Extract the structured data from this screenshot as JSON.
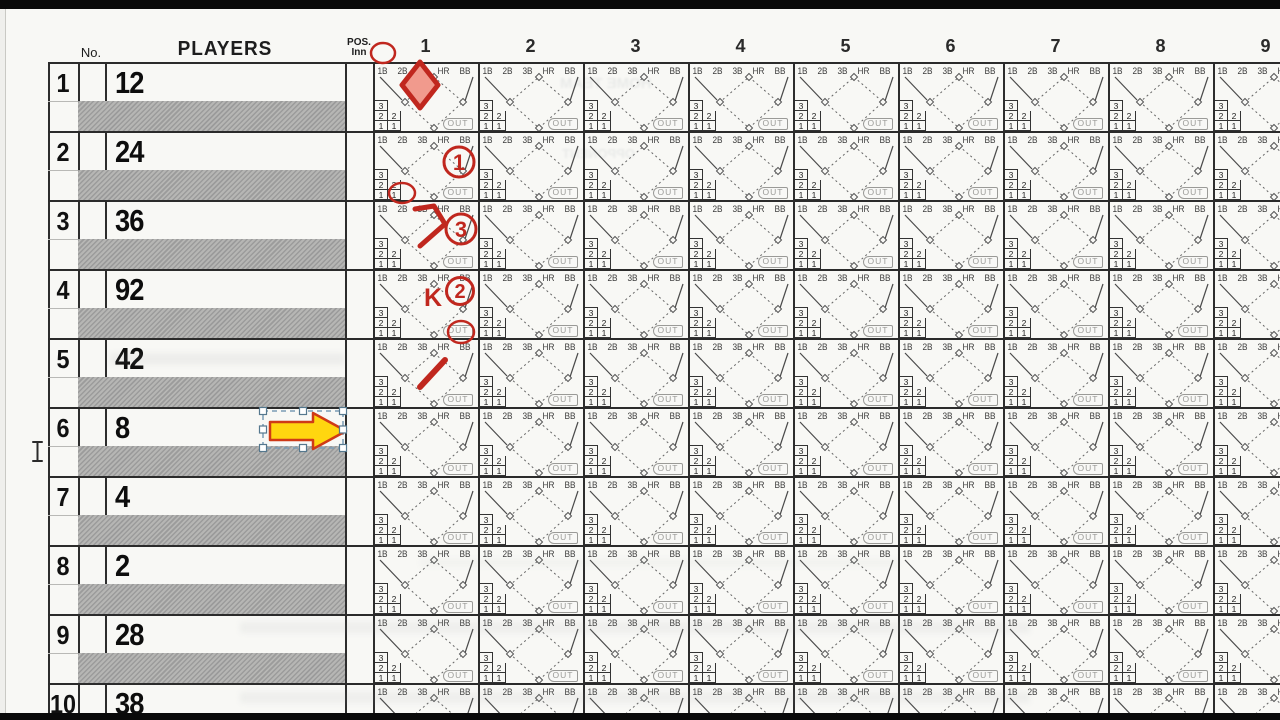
{
  "document": {
    "kind": "baseball scorebook page (scanned)"
  },
  "header": {
    "no": "No.",
    "players": "PLAYERS",
    "pos_line1": "POS.",
    "pos_line2": "Inn",
    "innings": [
      "1",
      "2",
      "3",
      "4",
      "5",
      "6",
      "7",
      "8",
      "9"
    ]
  },
  "cell": {
    "base_labels": [
      "1B",
      "2B",
      "3B",
      "HR",
      "BB"
    ],
    "counter_rows": [
      [
        "3"
      ],
      [
        "2",
        "2"
      ],
      [
        "1",
        "1"
      ]
    ],
    "out_label": "OUT"
  },
  "roster": [
    {
      "order": "1",
      "number": "12"
    },
    {
      "order": "2",
      "number": "24"
    },
    {
      "order": "3",
      "number": "36"
    },
    {
      "order": "4",
      "number": "92"
    },
    {
      "order": "5",
      "number": "42"
    },
    {
      "order": "6",
      "number": "8"
    },
    {
      "order": "7",
      "number": "4"
    },
    {
      "order": "8",
      "number": "2"
    },
    {
      "order": "9",
      "number": "28"
    },
    {
      "order": "10",
      "number": "38"
    }
  ],
  "annotations": {
    "ink_color": "#c0271e",
    "marks": [
      {
        "id": "row1-hit-1b-circle",
        "kind": "circled-base-label",
        "label": "1B"
      },
      {
        "id": "row1-scored-diamond",
        "kind": "filled-diamond",
        "label": ""
      },
      {
        "id": "row2-out-number",
        "kind": "circled-number",
        "label": "1"
      },
      {
        "id": "row3-hit-2b-circle",
        "kind": "circled-base-label",
        "label": "2B"
      },
      {
        "id": "row3-advance-path",
        "kind": "base-path",
        "label": ""
      },
      {
        "id": "row3-out-number",
        "kind": "circled-number",
        "label": "3"
      },
      {
        "id": "row4-strikeout",
        "kind": "letter",
        "label": "K"
      },
      {
        "id": "row4-out-number",
        "kind": "circled-number",
        "label": "2"
      },
      {
        "id": "row5-walk-bb-circle",
        "kind": "circled-base-label",
        "label": "BB"
      },
      {
        "id": "row5-advance-path",
        "kind": "base-path",
        "label": ""
      }
    ],
    "arrow_tool": {
      "selected": true,
      "fill": "#ffd60f",
      "outline": "#cf3a17",
      "handle_color": "#ffffff",
      "selection_color": "#7b9cb5"
    }
  },
  "ghost_texts": [
    "HOME TEAM",
    "OPPONENT"
  ],
  "colors": {
    "paper": "#f8f8f5",
    "grid": "#2d2d2d",
    "shaded_row": "#a8a8a6",
    "diamond_fill": "#f19a8d",
    "letterbox": "#0a0a0a"
  }
}
